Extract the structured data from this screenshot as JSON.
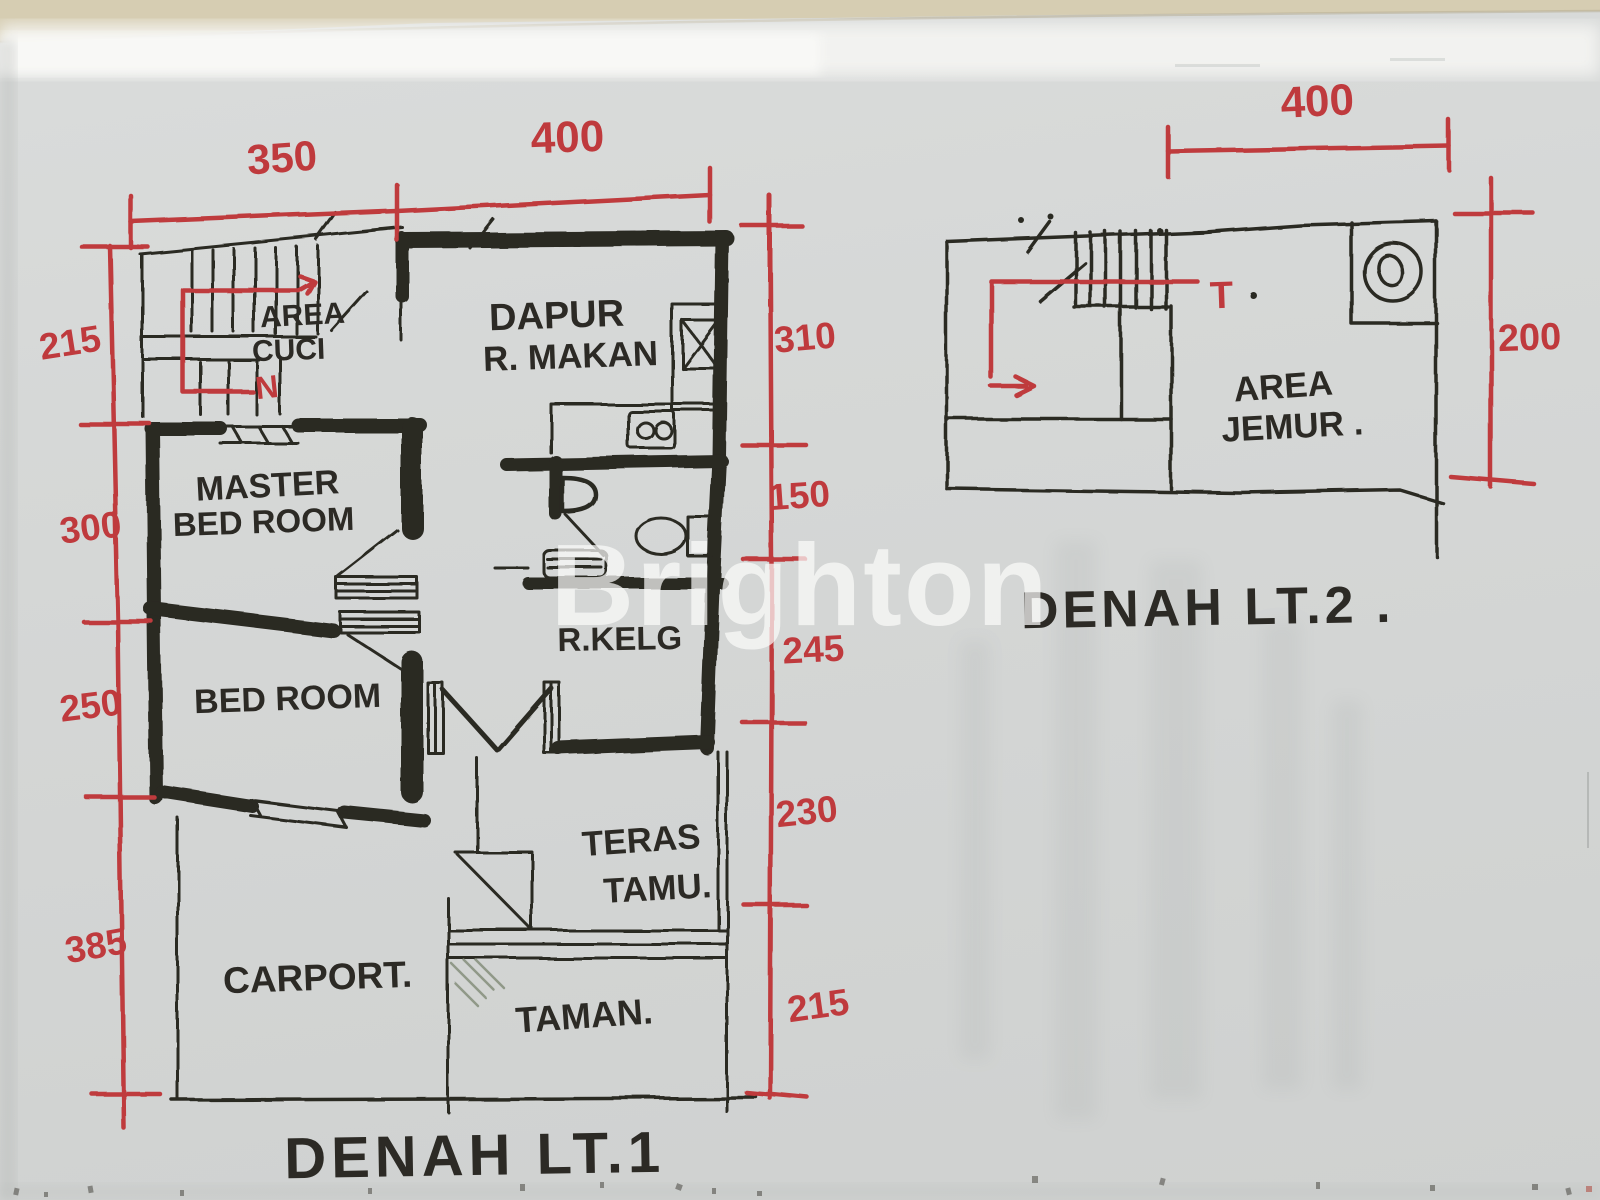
{
  "watermark": {
    "text": "Brighton"
  },
  "colors": {
    "ink": "#2c2a25",
    "dimension_red": "#bf3a3d",
    "paper": "#d5d7d6",
    "table_edge_tan": "#d6cdb2",
    "garden_hatch": "#8b9681"
  },
  "floor1": {
    "title": "DENAH LT.1",
    "stair_direction": "N",
    "dims": {
      "top": [
        "350",
        "400"
      ],
      "left": [
        "215",
        "300",
        "250",
        "385"
      ],
      "right": [
        "310",
        "150",
        "245",
        "230",
        "215"
      ]
    },
    "rooms": {
      "area_cuci": [
        "AREA",
        "CUCI"
      ],
      "dapur": [
        "DAPUR",
        "R. MAKAN"
      ],
      "master_bedroom": [
        "MASTER",
        "BED ROOM"
      ],
      "bedroom": [
        "BED ROOM"
      ],
      "keluarga": [
        "R.KELG"
      ],
      "teras": [
        "TERAS",
        "TAMU."
      ],
      "carport": [
        "CARPORT."
      ],
      "taman": [
        "TAMAN."
      ]
    }
  },
  "floor2": {
    "title": "DENAH LT.2 .",
    "stair_direction": "T",
    "dims": {
      "top": [
        "400"
      ],
      "right": [
        "200"
      ]
    },
    "rooms": {
      "area_jemur": [
        "AREA",
        "JEMUR ."
      ]
    }
  }
}
